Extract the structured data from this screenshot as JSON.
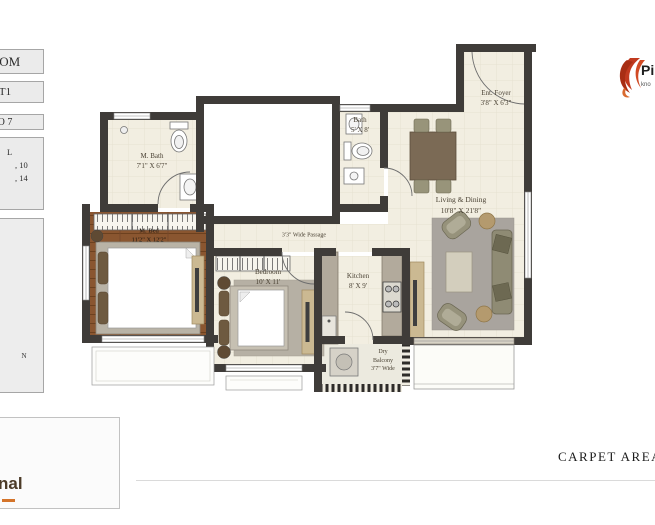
{
  "sidebar": {
    "box1_label": "OOM",
    "box2_label": "T1",
    "box3_label": "O 7",
    "box4_line1": "L",
    "box4_line2": ", 10",
    "box4_line3": ", 14",
    "compass_n": "N"
  },
  "brand": {
    "top_name": "Pi",
    "top_tagline": "kno",
    "bottom_name": "nal"
  },
  "footer": {
    "carpet_area_label": "CARPET AREA  :"
  },
  "rooms": {
    "m_bath": {
      "name": "M. Bath",
      "dims": "7'1\" X 6'7\""
    },
    "bath": {
      "name": "Bath",
      "dims": "5' X 8'"
    },
    "ent_foyer": {
      "name": "Ent. Foyer",
      "dims": "3'8\" X 6'3\""
    },
    "living": {
      "name": "Living & Dining",
      "dims": "10'8\" X 21'8\""
    },
    "m_bed": {
      "name": "M. Bed",
      "dims": "11'2\" X 12'2\""
    },
    "bedroom": {
      "name": "Bedroom",
      "dims": "10' X 11'"
    },
    "kitchen": {
      "name": "Kitchen",
      "dims": "8' X 9'"
    },
    "dry_balcony": {
      "line1": "Dry",
      "line2": "Balcony",
      "line3": "3'7\" Wide"
    },
    "passage": {
      "label": "3'3\" Wide Passage"
    }
  },
  "colors": {
    "wall": "#3f3c39",
    "floor": "#f2eee1",
    "wood_floor": "#8a5630",
    "flame_accent": "#c13a1f",
    "tree_accent": "#8a5a2b"
  }
}
